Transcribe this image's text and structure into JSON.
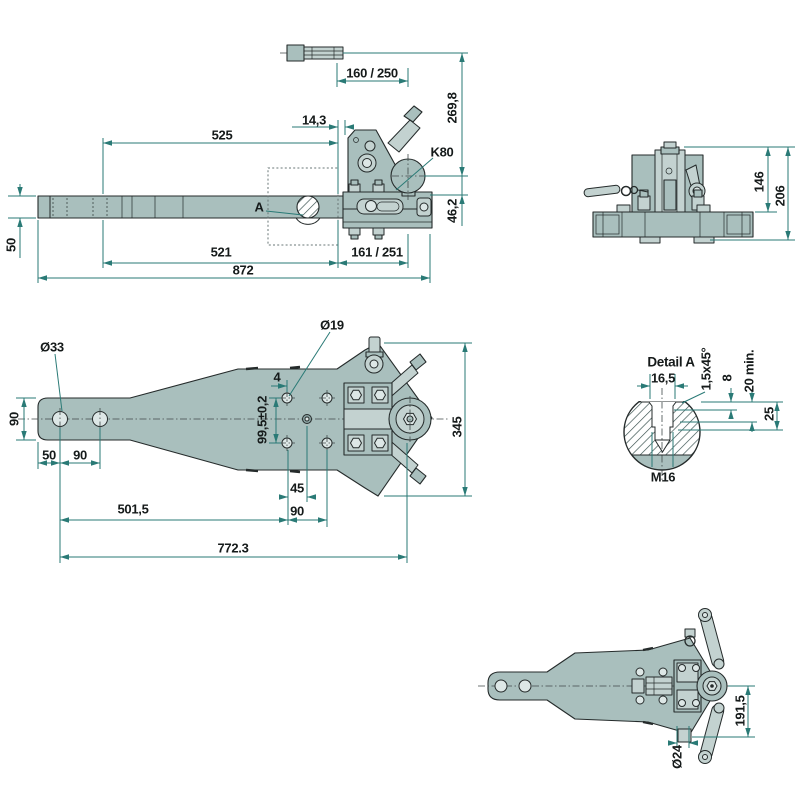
{
  "colors": {
    "background": "#ffffff",
    "part_fill": "#a9bfbd",
    "part_fill_light": "#c3d2d0",
    "outline": "#252b2b",
    "dimension": "#2a7a76",
    "text": "#151a1a"
  },
  "views": {
    "side": {
      "labels": {
        "dim_160_250": "160 / 250",
        "dim_269_8": "269,8",
        "ball_type": "K80",
        "dim_46_2": "46,2",
        "dim_525": "525",
        "dim_14_3": "14,3",
        "detail_ref": "A",
        "dim_50": "50",
        "dim_521": "521",
        "dim_161_251": "161 / 251",
        "dim_872": "872"
      }
    },
    "front": {
      "labels": {
        "dim_146": "146",
        "dim_206": "206"
      }
    },
    "top": {
      "labels": {
        "dia_19": "Ø19",
        "dia_33": "Ø33",
        "dim_4": "4",
        "dim_99_5": "99,5±0,2",
        "dim_90_left": "90",
        "dim_50": "50",
        "dim_90_holes": "90",
        "dim_45": "45",
        "dim_90_bottom": "90",
        "dim_501_5": "501,5",
        "dim_772_3": "772.3",
        "dim_345": "345"
      }
    },
    "detail_a": {
      "labels": {
        "title": "Detail A",
        "dim_16_5": "16,5",
        "chamfer": "1,5x45°",
        "dim_8": "8",
        "dim_20_min": "20 min.",
        "dim_25": "25",
        "thread": "M16"
      }
    },
    "bottom": {
      "labels": {
        "dim_191_5": "191,5",
        "dia_24": "Ø24"
      }
    }
  }
}
